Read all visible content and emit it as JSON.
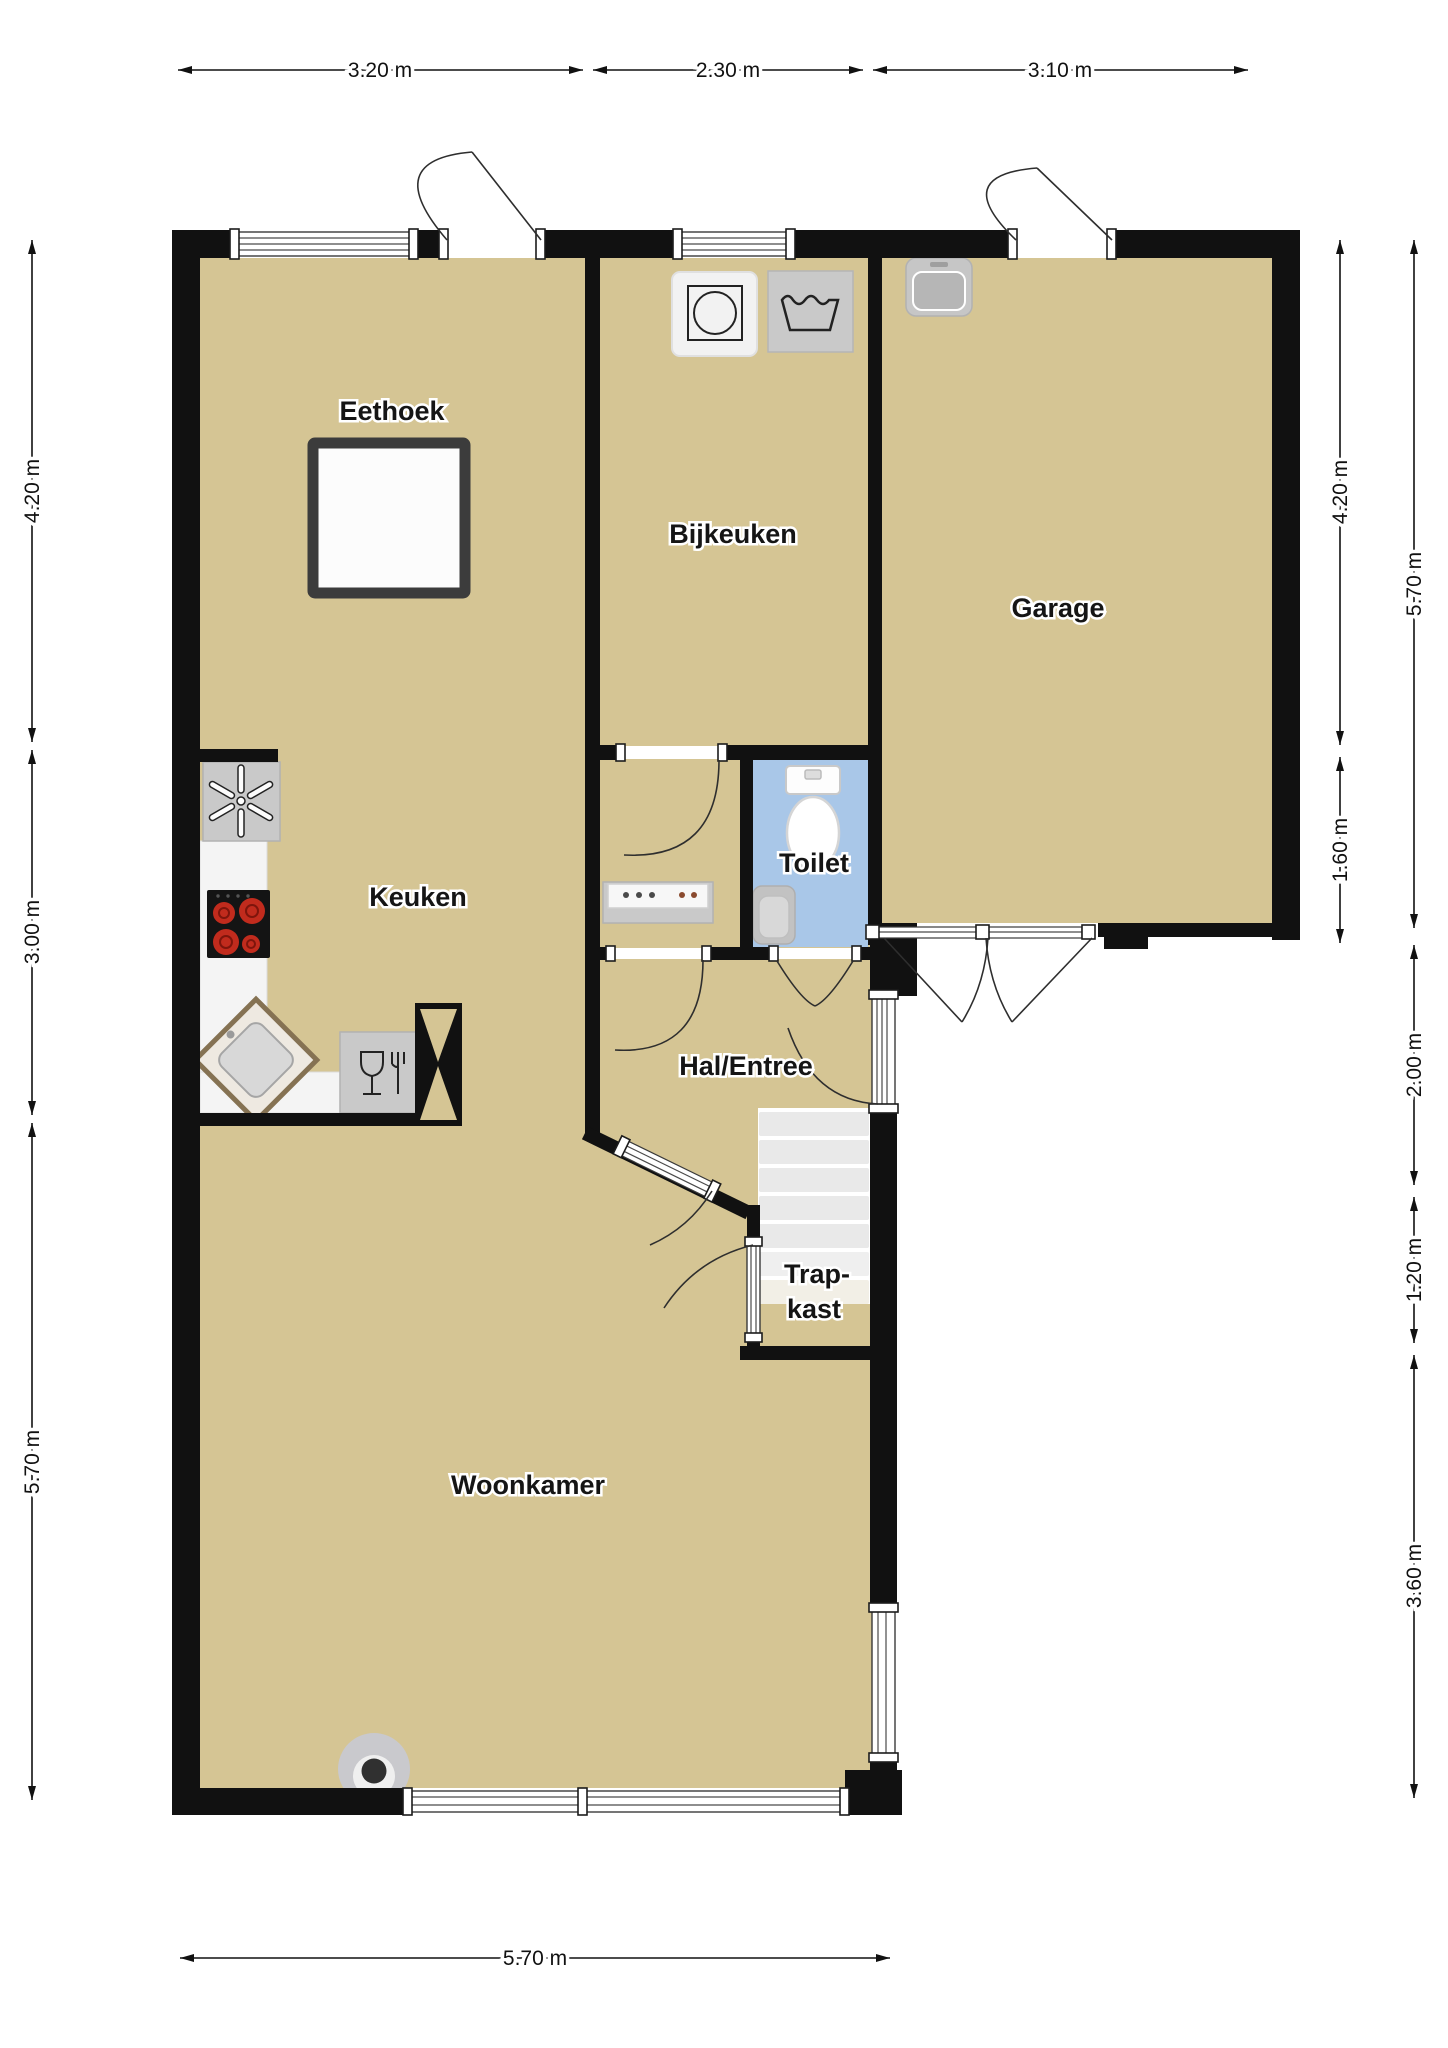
{
  "title": "Begane grond plattegrond",
  "rooms": {
    "eethoek": {
      "label": "Eethoek"
    },
    "bijkeuken": {
      "label": "Bijkeuken"
    },
    "garage": {
      "label": "Garage"
    },
    "keuken": {
      "label": "Keuken"
    },
    "toilet": {
      "label": "Toilet"
    },
    "hal": {
      "label": "Hal/Entree"
    },
    "trapkast": {
      "line1": "Trap-",
      "line2": "kast"
    },
    "woonkamer": {
      "label": "Woonkamer"
    }
  },
  "dimensions": {
    "top": [
      {
        "label": "3.20 m"
      },
      {
        "label": "2.30 m"
      },
      {
        "label": "3.10 m"
      }
    ],
    "left": [
      {
        "label": "4.20 m"
      },
      {
        "label": "3.00 m"
      },
      {
        "label": "5.70 m"
      }
    ],
    "right_inner": [
      {
        "label": "4.20 m"
      },
      {
        "label": "1.60 m"
      }
    ],
    "right_outer": [
      {
        "label": "5.70 m"
      },
      {
        "label": "2.00 m"
      },
      {
        "label": "1.20 m"
      },
      {
        "label": "3.60 m"
      }
    ],
    "bottom": [
      {
        "label": "5.70 m"
      }
    ]
  },
  "icons": [
    "washing-machine-icon",
    "laundry-tub-icon",
    "garage-sink-icon",
    "extractor-fan-icon",
    "cooktop-icon",
    "kitchen-sink-icon",
    "dishwasher-icon",
    "sideboard-icon",
    "toilet-icon",
    "hand-basin-icon",
    "dining-table",
    "stairs",
    "column-icon",
    "chimney-icon"
  ],
  "colors": {
    "wall": "#111111",
    "floor": "#D5C594",
    "toilet_floor": "#A9C7E8",
    "appliance": "#C9C9C9",
    "counter": "#F4F4F4",
    "burner_red": "#C12B1D",
    "stairs_step": "#E9E9E9",
    "table_border": "#3C3C3C"
  }
}
